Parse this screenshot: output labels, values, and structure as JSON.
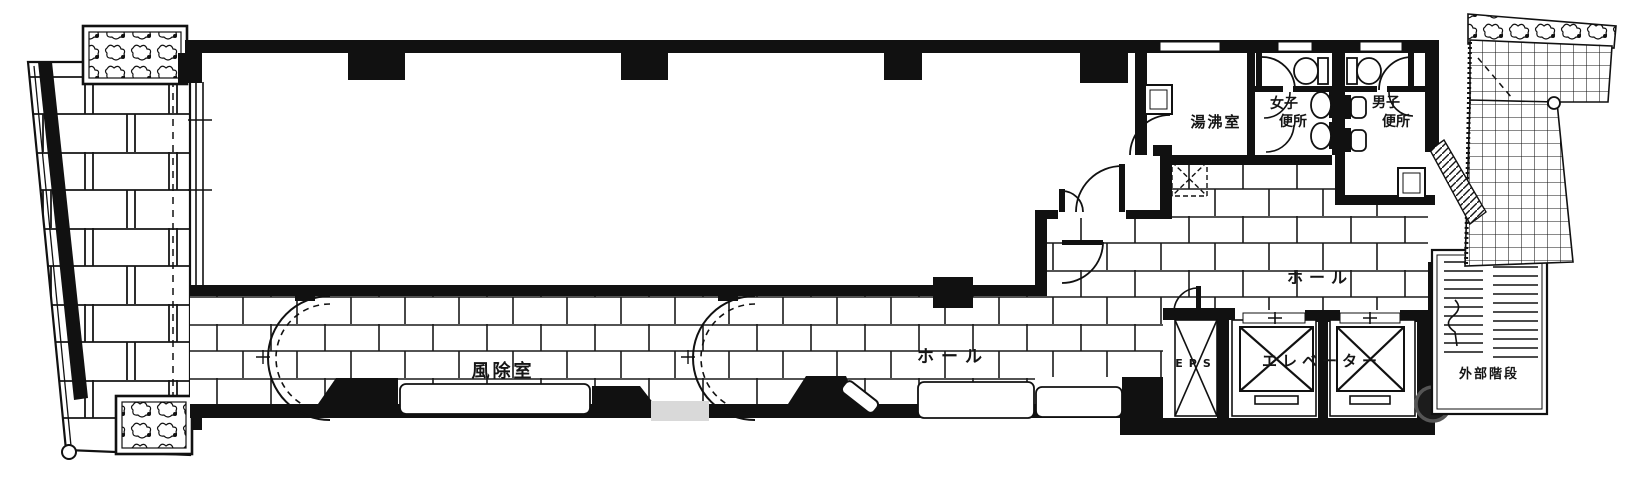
{
  "drawing": {
    "kind": "architectural-floor-plan",
    "labels": {
      "vestibule": "風除室",
      "hall_lower": "ホール",
      "hall_upper": "ホール",
      "kitchenette": "湯沸室",
      "womens_toilet": [
        "女子",
        "便所"
      ],
      "mens_toilet": [
        "男子",
        "便所"
      ],
      "eps": "EPS",
      "elevator": "エレベーター",
      "external_stairs": "外部階段"
    },
    "colors": {
      "ink": "#151515",
      "paper": "#ffffff",
      "pad_gray": "#d9d9d9"
    }
  }
}
